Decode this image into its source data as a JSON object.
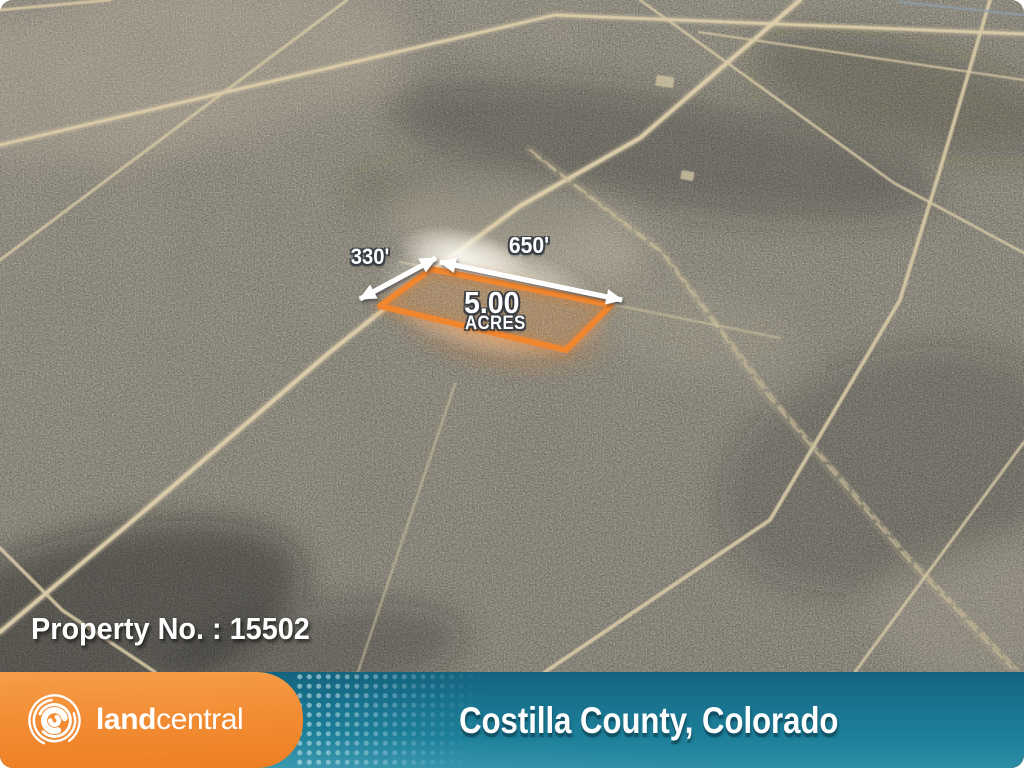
{
  "overlay": {
    "property_number_label": "Property No. : 15502",
    "parcel": {
      "area_value": "5.00",
      "area_unit": "ACRES",
      "top_dimension": "650'",
      "left_dimension": "330'"
    }
  },
  "footer": {
    "brand_bold": "land",
    "brand_regular": "central",
    "location": "Costilla County, Colorado"
  },
  "icons": {
    "logo": "landcentral-swirl-icon",
    "dimension_arrows": "double-headed-arrow-icon"
  },
  "colors": {
    "brand_orange": "#F28C34",
    "brand_teal": "#17718C",
    "parcel_outline_orange": "#F0862F",
    "parcel_fill_tan": "#B98A58",
    "road_tan": "#DACCA9",
    "terrain_gray_brown": "#7D7969",
    "label_white": "#FFFFFF"
  }
}
